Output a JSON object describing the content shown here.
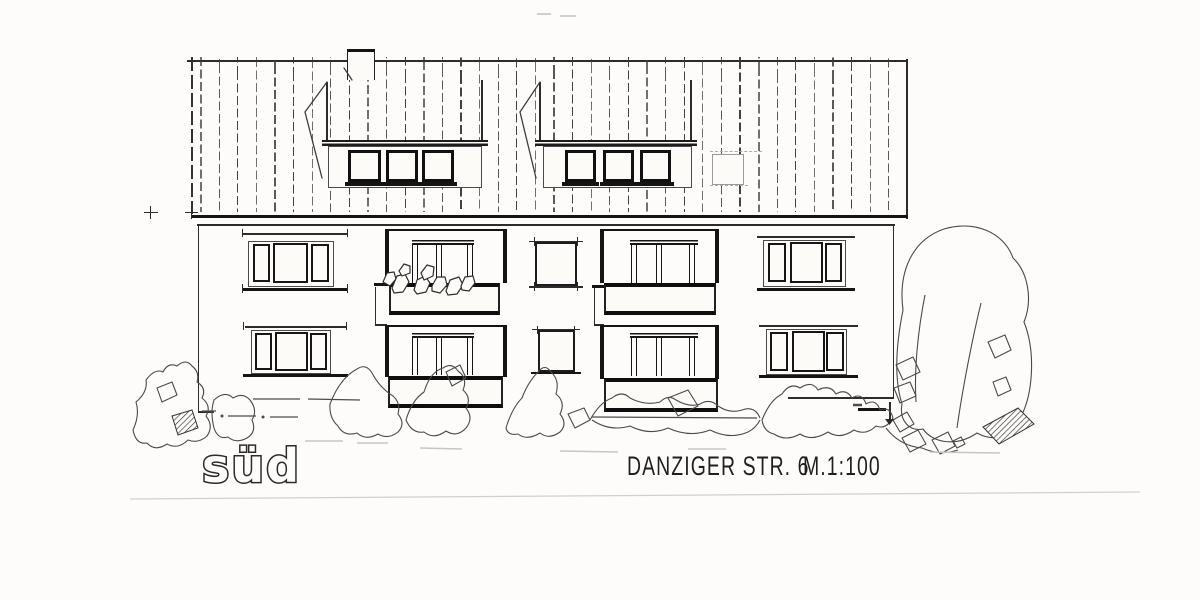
{
  "labels": {
    "elevation": "süd",
    "street": "DANZIGER STR. 6",
    "scale": "M.1:100"
  },
  "colors": {
    "paper": "#fcfbf8",
    "ink": "#2b2b2b",
    "faint": "#c8c6c2"
  },
  "drawing_elements": {
    "roof": "vertically battened roof with ridge, two shed dormers (3 windows each), chimney, roof hatch",
    "facade": "two storeys: flanking 3-pane windows, two recessed balcony bays with railings and parapets, small single windows between",
    "landscape": "hand-sketched shrubs along ground line and large tree at right"
  }
}
